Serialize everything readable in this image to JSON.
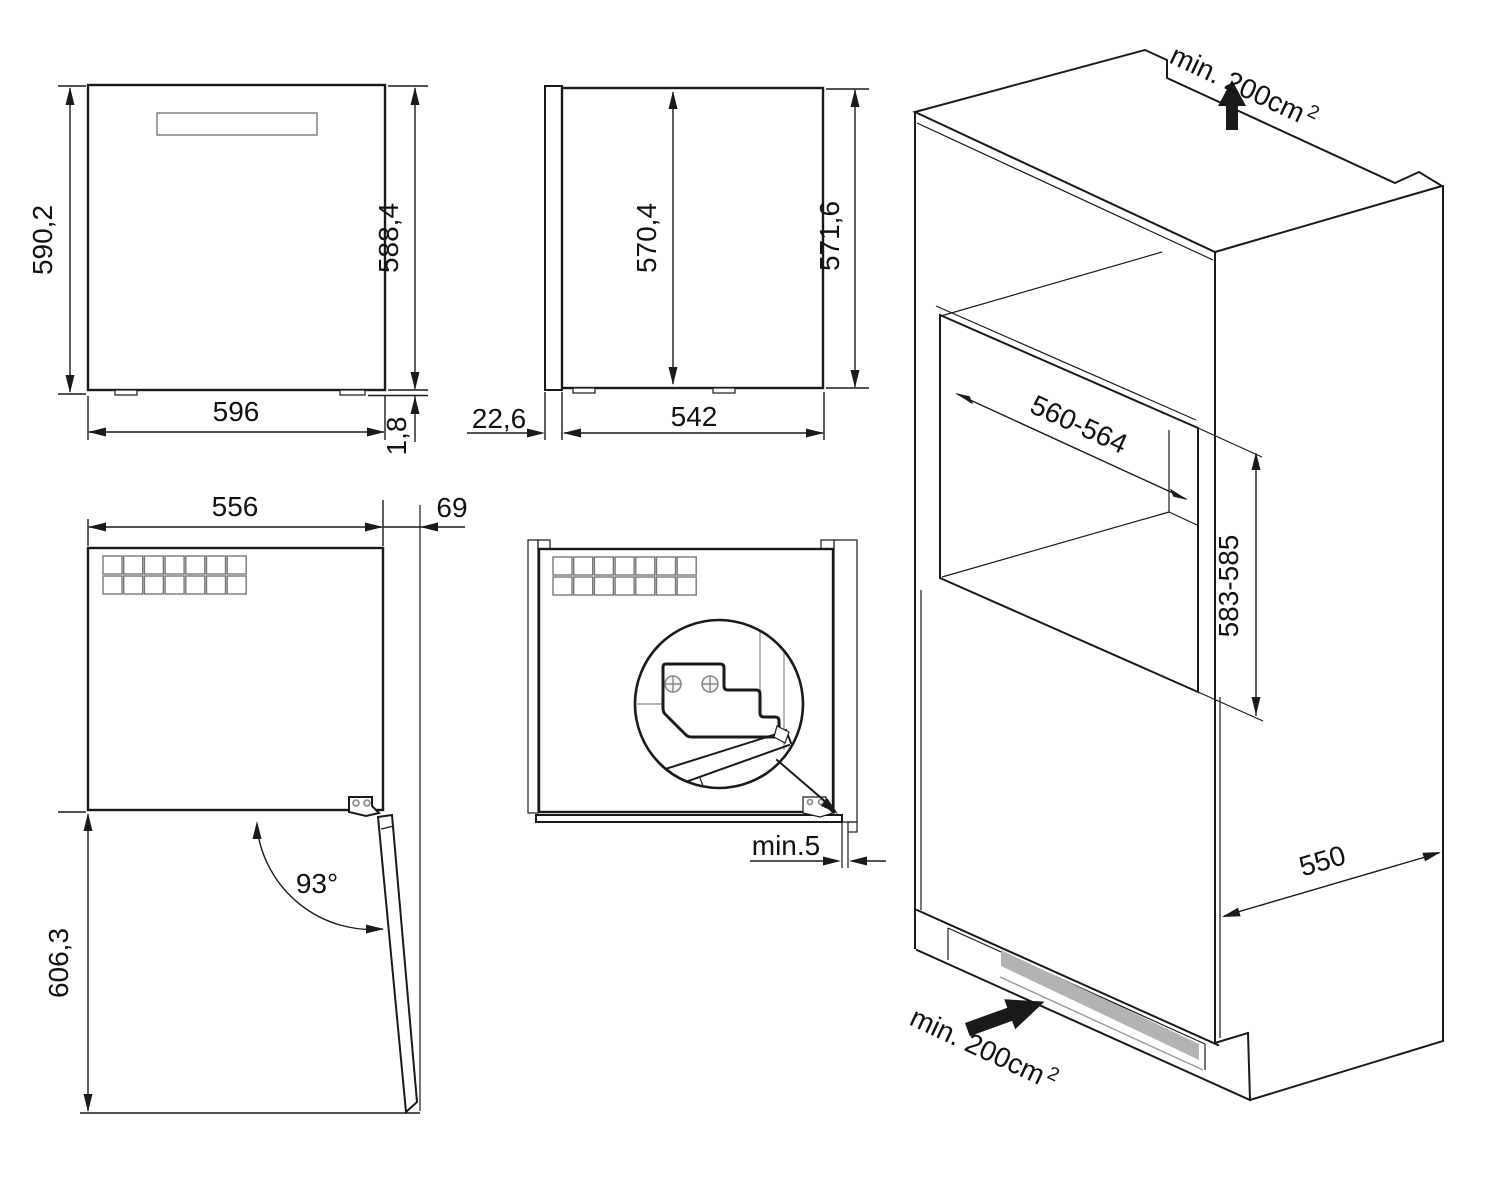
{
  "views": {
    "front": {
      "height_total": "590,2",
      "height_body": "588,4",
      "width": "596",
      "foot_height": "1,8"
    },
    "side": {
      "inner_height": "570,4",
      "total_height": "571,6",
      "door_depth": "22,6",
      "body_depth": "542"
    },
    "top_open": {
      "body_width": "556",
      "door_offset": "69",
      "door_angle": "93°",
      "open_depth": "606,3"
    },
    "installed": {
      "side_gap": "min.5"
    },
    "cabinet": {
      "top_vent": "min. 200cm",
      "top_vent_sup": "2",
      "niche_width": "560-564",
      "niche_height": "583-585",
      "depth": "550",
      "bottom_vent": "min. 200cm",
      "bottom_vent_sup": "2"
    }
  },
  "colors": {
    "line": "#1a1a1a",
    "gray_line": "#999999",
    "vent_fill": "#b3b3b3"
  }
}
